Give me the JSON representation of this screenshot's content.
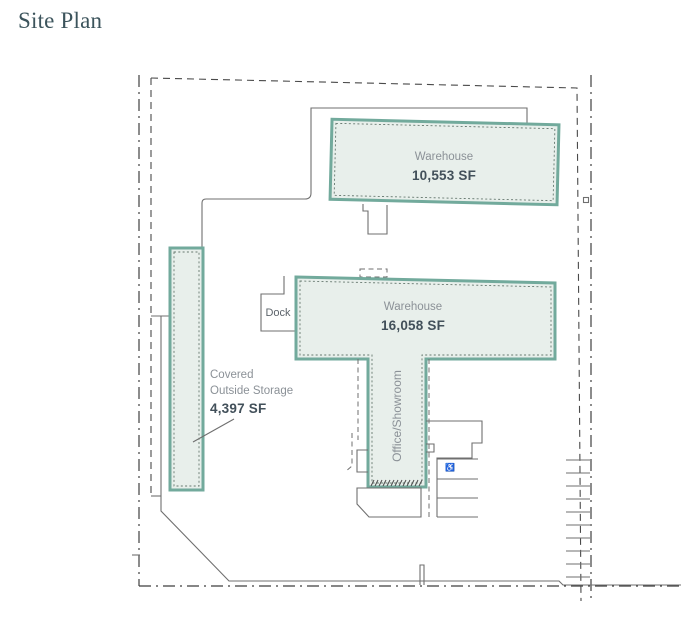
{
  "title": "Site Plan",
  "colors": {
    "accent": "#72aa9c",
    "building_fill": "#e8efeb",
    "outline_gray": "#6f6f6f",
    "boundary_dark": "#3f3f3f",
    "label_gray": "#8b9197",
    "label_dark": "#42505a",
    "title_color": "#3c545c"
  },
  "buildings": {
    "warehouse_top": {
      "name": "Warehouse",
      "area": "10,553 SF"
    },
    "warehouse_main": {
      "name": "Warehouse",
      "area": "16,058 SF"
    },
    "office": {
      "name": "Office/Showroom"
    },
    "storage": {
      "name_line1": "Covered",
      "name_line2": "Outside Storage",
      "area": "4,397 SF"
    },
    "dock": {
      "name": "Dock"
    }
  },
  "icons": {
    "accessible_parking": "♿"
  }
}
